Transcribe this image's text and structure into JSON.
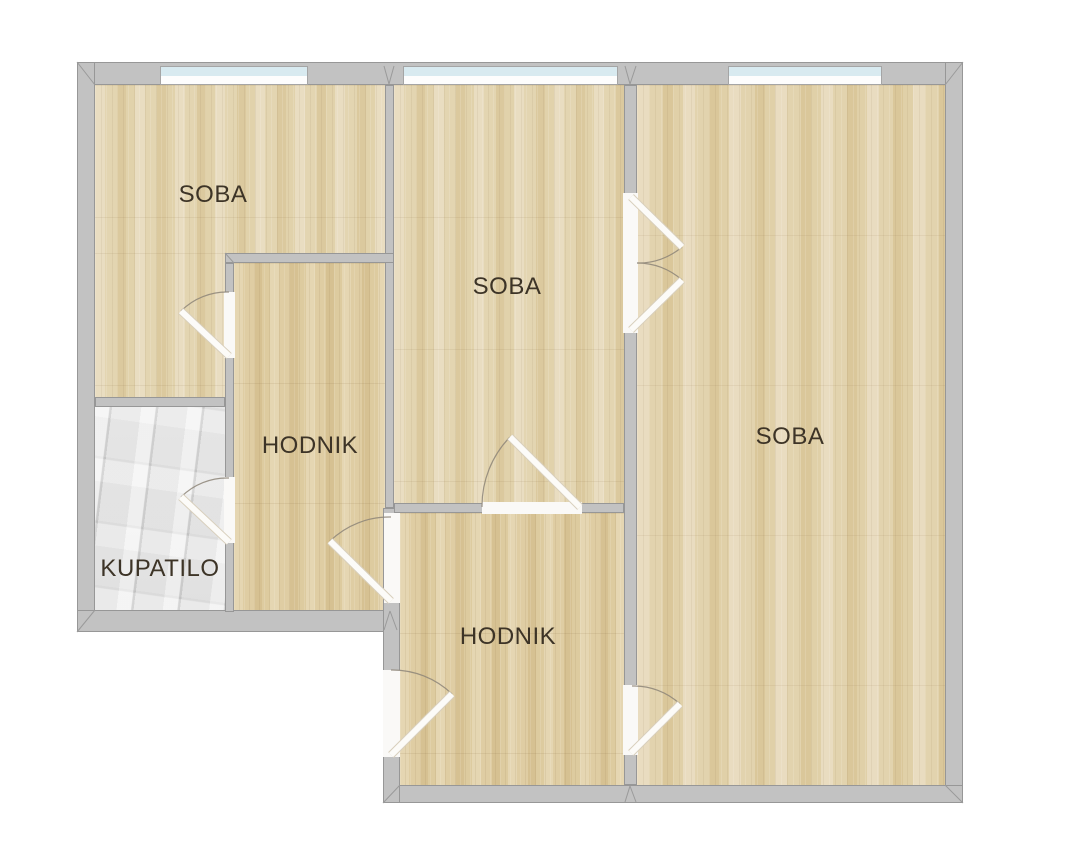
{
  "plan": {
    "type": "apartment-floor-plan",
    "rooms": [
      {
        "id": "soba-top-left",
        "label": "SOBA"
      },
      {
        "id": "soba-middle",
        "label": "SOBA"
      },
      {
        "id": "soba-right",
        "label": "SOBA"
      },
      {
        "id": "hodnik-upper",
        "label": "HODNIK"
      },
      {
        "id": "hodnik-lower",
        "label": "HODNIK"
      },
      {
        "id": "kupatilo",
        "label": "KUPATILO"
      }
    ],
    "colors": {
      "wall": "#c2c2c2",
      "wall_edge": "#979797",
      "wood_floor": "#e2d3ad",
      "tile_floor": "#dcdcdc",
      "window_glass": "#d8eaf0",
      "door_leaf": "#fcfbf8",
      "label_text": "#3d3427"
    },
    "counts": {
      "windows": 3,
      "single_doors": 6,
      "double_doors": 1
    }
  }
}
